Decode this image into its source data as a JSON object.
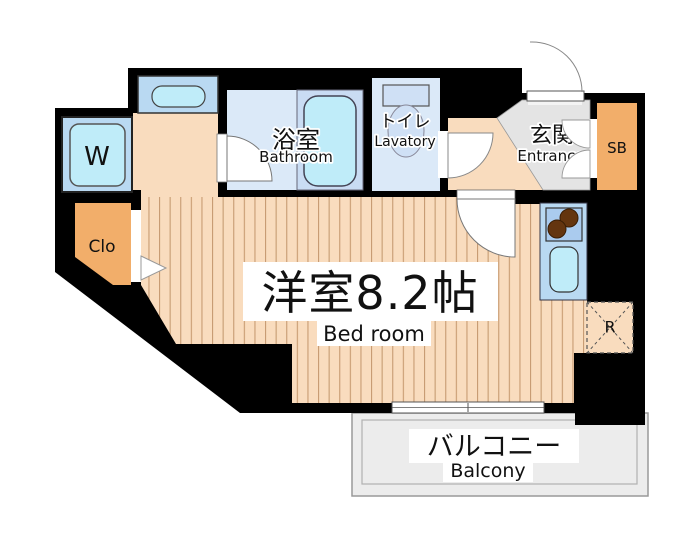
{
  "floorplan": {
    "bedroom": {
      "name_jp": "洋室8.2帖",
      "name_en": "Bed room"
    },
    "bathroom": {
      "name_jp": "浴室",
      "name_en": "Bathroom"
    },
    "lavatory": {
      "name_jp": "トイレ",
      "name_en": "Lavatory"
    },
    "entrance": {
      "name_jp": "玄関",
      "name_en": "Entrance"
    },
    "balcony": {
      "name_jp": "バルコニー",
      "name_en": "Balcony"
    },
    "closet_label": "Clo",
    "washer_label": "W",
    "shoebox_label": "SB",
    "refrigerator_label": "R"
  },
  "colors": {
    "wall": "#000000",
    "floor": "#f9dcbe",
    "floor_stripe": "#c79b72",
    "room_blue": "#dbe9f8",
    "platform_blue": "#c9dcf3",
    "panel_blue": "#b9d9f2",
    "fixture_cyan": "#bfecf9",
    "fixture_blue": "#cfe0f5",
    "stove_blue": "#aacbee",
    "accent_orange": "#f2ae6a",
    "entrance_gray": "#e4e4e4",
    "balcony_gray": "#ececec",
    "burner_brown": "#64350f"
  }
}
